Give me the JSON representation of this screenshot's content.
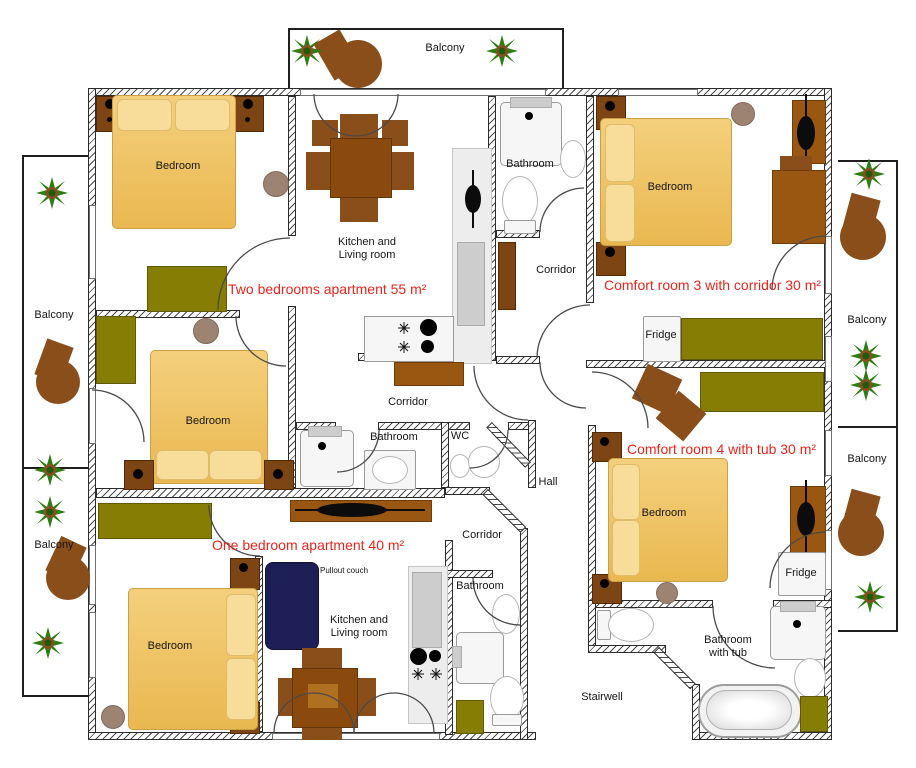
{
  "plan": {
    "apartments": {
      "two_bedroom": {
        "label": "Two bedrooms apartment 55 m²"
      },
      "comfort_3": {
        "label": "Comfort room 3 with corridor 30 m²"
      },
      "comfort_4": {
        "label": "Comfort room 4 with tub 30 m²"
      },
      "one_bedroom": {
        "label": "One bedroom apartment 40 m²"
      }
    },
    "room_labels": {
      "balcony": "Balcony",
      "bedroom": "Bedroom",
      "kitchen_living": "Kitchen and Living room",
      "bathroom": "Bathroom",
      "bathroom_with_tub": "Bathroom with tub",
      "corridor": "Corridor",
      "wc": "WC",
      "hall": "Hall",
      "stairwell": "Stairwell"
    },
    "furniture_labels": {
      "fridge": "Fridge",
      "pullout_couch": "Pullout couch"
    },
    "colors": {
      "apartment_label_red": "#e6261c",
      "bed_tan": "#efc262",
      "wood_brown": "#9a5712",
      "dresser_olive": "#867d05",
      "couch_navy": "#1d1f56",
      "plant_green": "#2e7d12",
      "wall_hatch": "#4a4a4a"
    }
  }
}
